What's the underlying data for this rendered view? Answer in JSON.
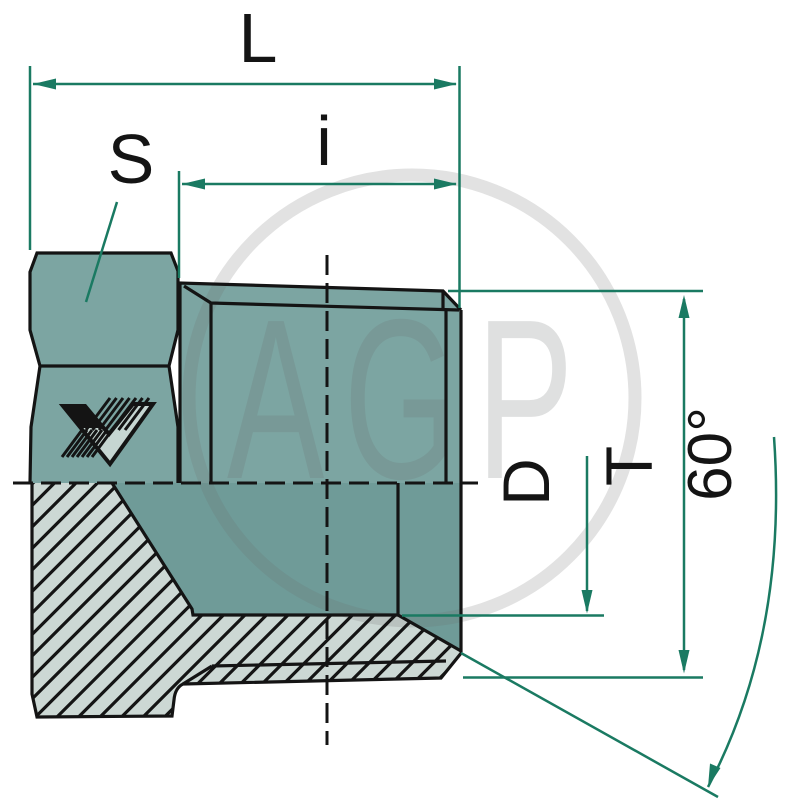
{
  "drawing": {
    "kind": "technical-drawing-section",
    "part": "hydraulic blanking plug with hex head",
    "watermark": {
      "text": "AGP"
    },
    "labels": {
      "overall_length": "L",
      "thread_length": "i",
      "hex_across_flats": "S",
      "thread_diameter": "D",
      "outer_diameter": "T",
      "cone_angle": "60°"
    },
    "colors": {
      "dimension": "#1a7a62",
      "body": "#7ca5a2",
      "bore": "#6f9b98",
      "section_fill": "#ccd8d4",
      "outline": "#141414",
      "logo_light": "#c6d6d2"
    }
  }
}
